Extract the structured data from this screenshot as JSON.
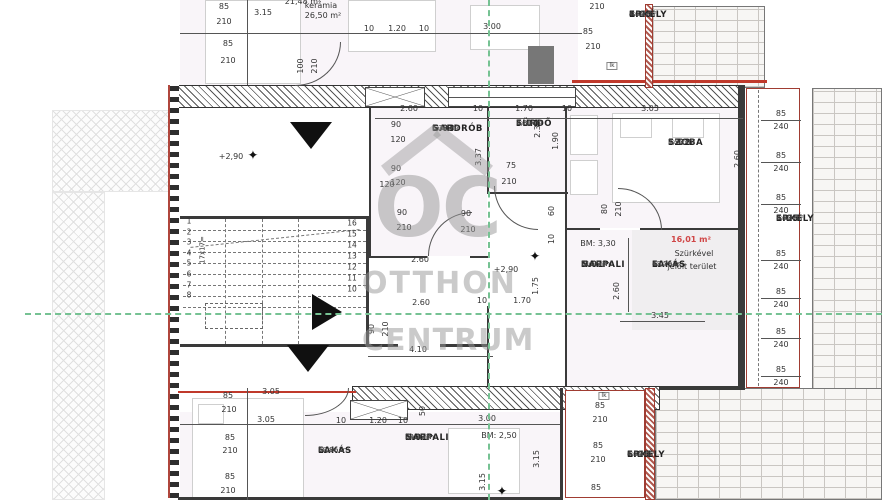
{
  "watermark": {
    "initials": "OC",
    "line1": "OTTHON",
    "line2": "CENTRUM"
  },
  "rooms": [
    {
      "id": "5.03",
      "name": "GARDRÓB",
      "material": "kerámia",
      "area": "6,77 m²",
      "x": 432,
      "y": 124
    },
    {
      "id": "5.04",
      "name": "FÜRDŐ",
      "material": "kerámia",
      "area": "3,86 m²",
      "x": 516,
      "y": 119
    },
    {
      "id": "5.02",
      "name": "SZOBA",
      "material": "kerámia",
      "area": "7,93 m²",
      "x": 668,
      "y": 138
    },
    {
      "id": "5.01",
      "name": "NAPPALI",
      "material": "kerámia",
      "area": "21,09 m²",
      "x": 581,
      "y": 260
    },
    {
      "id": "5.",
      "name": "LAKÁS",
      "material": "kerámia",
      "area": "43,79 m²",
      "x": 652,
      "y": 260
    },
    {
      "id": "5.05",
      "name": "ERKÉLY",
      "material": "kerámia",
      "area": "8,93 m²",
      "x": 776,
      "y": 214
    },
    {
      "id": "4.05",
      "name": "ERKÉLY",
      "material": "kerámia",
      "area": "4,34 m²",
      "x": 629,
      "y": 10
    },
    {
      "id": "6.",
      "name": "LAKÁS",
      "material": "kerámia",
      "area": "50,86 m²",
      "x": 318,
      "y": 446
    },
    {
      "id": "6.01",
      "name": "NAPPALI",
      "material": "kerámia",
      "area": "24,13 m²",
      "x": 405,
      "y": 433
    },
    {
      "id": "6.05",
      "name": "ERKÉLY",
      "material": "kerámia",
      "area": "4,34 m²",
      "x": 627,
      "y": 450
    }
  ],
  "partials": [
    {
      "text": "21,48 m²",
      "x": 303,
      "y": 2
    },
    {
      "text": "kerámia",
      "x": 321,
      "y": 6
    },
    {
      "text": "26,50 m²",
      "x": 323,
      "y": 16
    }
  ],
  "annotations": [
    {
      "text": "BM: 3,30",
      "x": 598,
      "y": 244
    },
    {
      "text": "BM: 2,50",
      "x": 499,
      "y": 436
    },
    {
      "text": "+2,90",
      "x": 231,
      "y": 157
    },
    {
      "text": "+2,90",
      "x": 506,
      "y": 270
    },
    {
      "text": "16,01 m²",
      "x": 691,
      "y": 240,
      "red": true
    },
    {
      "text": "Szürkével",
      "x": 694,
      "y": 254
    },
    {
      "text": "jelölt terület",
      "x": 692,
      "y": 267
    },
    {
      "text": "lk",
      "x": 612,
      "y": 66,
      "box": true
    },
    {
      "text": "lk",
      "x": 604,
      "y": 396,
      "box": true
    },
    {
      "text": "17x17=",
      "x": 203,
      "y": 250,
      "rot": true
    }
  ],
  "dims": [
    {
      "t": "85",
      "x": 224,
      "y": 7
    },
    {
      "t": "210",
      "x": 224,
      "y": 22
    },
    {
      "t": "3.15",
      "x": 263,
      "y": 13
    },
    {
      "t": "85",
      "x": 228,
      "y": 44
    },
    {
      "t": "210",
      "x": 228,
      "y": 61
    },
    {
      "t": "100",
      "x": 301,
      "y": 66,
      "r": 1
    },
    {
      "t": "210",
      "x": 315,
      "y": 66,
      "r": 1
    },
    {
      "t": "10",
      "x": 369,
      "y": 29
    },
    {
      "t": "1.20",
      "x": 397,
      "y": 29
    },
    {
      "t": "10",
      "x": 424,
      "y": 29
    },
    {
      "t": "3.00",
      "x": 492,
      "y": 27
    },
    {
      "t": "210",
      "x": 597,
      "y": 7
    },
    {
      "t": "85",
      "x": 588,
      "y": 32
    },
    {
      "t": "210",
      "x": 593,
      "y": 47
    },
    {
      "t": "2.60",
      "x": 409,
      "y": 109
    },
    {
      "t": "10",
      "x": 478,
      "y": 109
    },
    {
      "t": "1.70",
      "x": 524,
      "y": 109
    },
    {
      "t": "10",
      "x": 567,
      "y": 109
    },
    {
      "t": "3.05",
      "x": 650,
      "y": 109
    },
    {
      "t": "90",
      "x": 396,
      "y": 125
    },
    {
      "t": "120",
      "x": 398,
      "y": 140
    },
    {
      "t": "90",
      "x": 396,
      "y": 169
    },
    {
      "t": "120",
      "x": 398,
      "y": 183
    },
    {
      "t": "3.37",
      "x": 479,
      "y": 157,
      "r": 1
    },
    {
      "t": "2.35",
      "x": 538,
      "y": 129,
      "r": 1
    },
    {
      "t": "1.90",
      "x": 556,
      "y": 141,
      "r": 1
    },
    {
      "t": "75",
      "x": 511,
      "y": 166
    },
    {
      "t": "210",
      "x": 509,
      "y": 182
    },
    {
      "t": "2.60",
      "x": 738,
      "y": 159,
      "r": 1
    },
    {
      "t": "80",
      "x": 605,
      "y": 209,
      "r": 1
    },
    {
      "t": "210",
      "x": 619,
      "y": 209,
      "r": 1
    },
    {
      "t": "90",
      "x": 466,
      "y": 214
    },
    {
      "t": "210",
      "x": 468,
      "y": 230
    },
    {
      "t": "60",
      "x": 552,
      "y": 211,
      "r": 1
    },
    {
      "t": "10",
      "x": 552,
      "y": 239,
      "r": 1
    },
    {
      "t": "120",
      "x": 387,
      "y": 185
    },
    {
      "t": "90",
      "x": 402,
      "y": 213
    },
    {
      "t": "210",
      "x": 404,
      "y": 228
    },
    {
      "t": "2.60",
      "x": 420,
      "y": 260
    },
    {
      "t": "2.60",
      "x": 421,
      "y": 303
    },
    {
      "t": "10",
      "x": 482,
      "y": 301
    },
    {
      "t": "1.70",
      "x": 522,
      "y": 301
    },
    {
      "t": "1.75",
      "x": 536,
      "y": 286,
      "r": 1
    },
    {
      "t": "90",
      "x": 372,
      "y": 329,
      "r": 1
    },
    {
      "t": "210",
      "x": 386,
      "y": 329,
      "r": 1
    },
    {
      "t": "4.10",
      "x": 418,
      "y": 350
    },
    {
      "t": "3.45",
      "x": 660,
      "y": 316
    },
    {
      "t": "2.60",
      "x": 617,
      "y": 291,
      "r": 1
    },
    {
      "t": "3.05",
      "x": 271,
      "y": 392
    },
    {
      "t": "85",
      "x": 228,
      "y": 396
    },
    {
      "t": "210",
      "x": 229,
      "y": 410
    },
    {
      "t": "3.05",
      "x": 266,
      "y": 420
    },
    {
      "t": "85",
      "x": 230,
      "y": 438
    },
    {
      "t": "210",
      "x": 230,
      "y": 451
    },
    {
      "t": "85",
      "x": 230,
      "y": 477
    },
    {
      "t": "210",
      "x": 228,
      "y": 491
    },
    {
      "t": "10",
      "x": 341,
      "y": 421
    },
    {
      "t": "1.20",
      "x": 378,
      "y": 421
    },
    {
      "t": "10",
      "x": 403,
      "y": 421
    },
    {
      "t": "50",
      "x": 423,
      "y": 411,
      "r": 1
    },
    {
      "t": "3.00",
      "x": 487,
      "y": 419
    },
    {
      "t": "3.15",
      "x": 537,
      "y": 459,
      "r": 1
    },
    {
      "t": "3.15",
      "x": 483,
      "y": 482,
      "r": 1
    },
    {
      "t": "85",
      "x": 600,
      "y": 406
    },
    {
      "t": "210",
      "x": 600,
      "y": 420
    },
    {
      "t": "85",
      "x": 598,
      "y": 446
    },
    {
      "t": "210",
      "x": 598,
      "y": 460
    },
    {
      "t": "85",
      "x": 596,
      "y": 488
    }
  ],
  "stairs": {
    "left": [
      "1",
      "2",
      "3",
      "4",
      "5",
      "6",
      "7",
      "8"
    ],
    "left_x": 189,
    "left_top": 221,
    "left_step": 10.6,
    "right": [
      "16",
      "15",
      "14",
      "13",
      "12",
      "11",
      "10"
    ],
    "right_x": 352,
    "right_top": 223,
    "right_step": 11
  },
  "balcony_505": {
    "x": 781,
    "pairs_y": [
      114,
      156,
      198,
      254,
      292,
      332,
      370
    ],
    "top": "85",
    "bottom": "240"
  },
  "markers": [
    {
      "x": 253,
      "y": 156
    },
    {
      "x": 535,
      "y": 257
    },
    {
      "x": 502,
      "y": 492
    }
  ],
  "colors": {
    "axis_green": "#76c293",
    "marking_red": "#c0392b",
    "wall_dark": "#3a3a3a",
    "watermark_gray": "#969696",
    "area_text_red": "#d04646",
    "balcony_border_red": "#a03c32"
  }
}
